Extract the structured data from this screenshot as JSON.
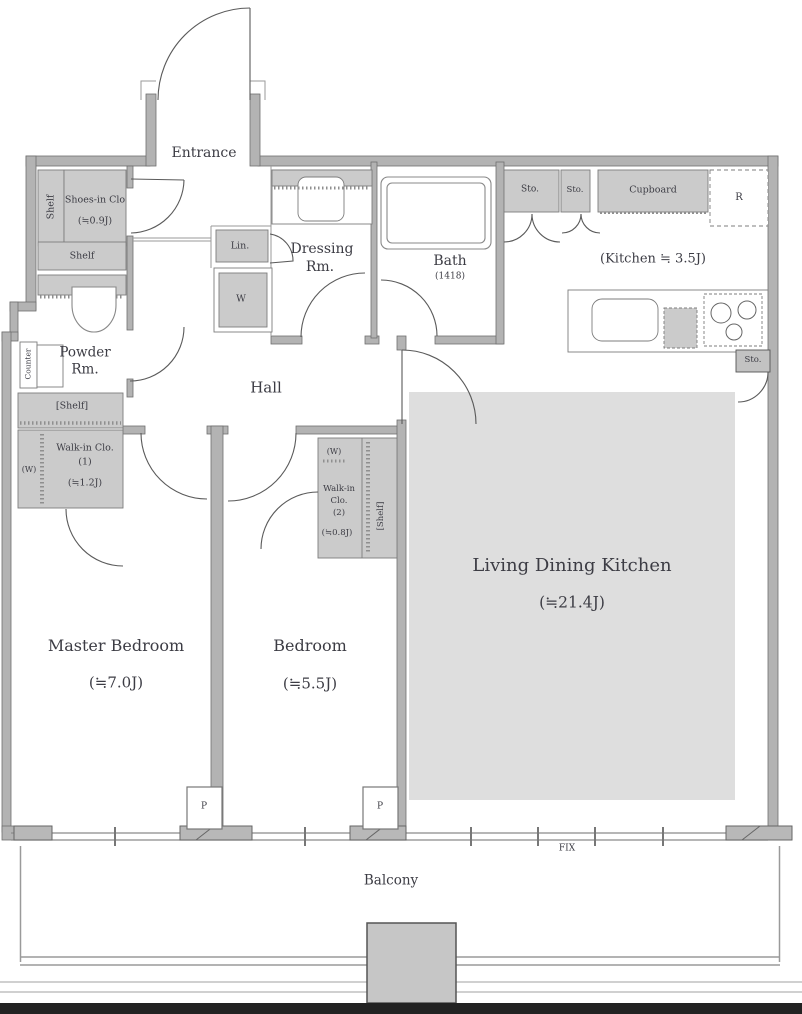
{
  "labels": {
    "entrance": "Entrance",
    "shoes_shelf_vertical": "Shelf",
    "shoes_closet": "Shoes-in Clo",
    "shoes_closet_size": "(≒0.9J)",
    "shelf_horizontal": "Shelf",
    "powder_line1": "Powder",
    "powder_line2": "Rm.",
    "counter": "Counter",
    "linen": "Lin.",
    "washer": "W",
    "dressing_line1": "Dressing",
    "dressing_line2": "Rm.",
    "bath": "Bath",
    "bath_size": "(1418)",
    "storage_a": "Sto.",
    "storage_b": "Sto.",
    "cupboard": "Cupboard",
    "refrigerator": "R",
    "kitchen": "(Kitchen ≒ 3.5J)",
    "storage_side": "Sto.",
    "hall": "Hall",
    "wic1_shelf": "[Shelf]",
    "wic1_w": "(W)",
    "wic1_line1": "Walk-in Clo.",
    "wic1_line2": "(1)",
    "wic1_size": "(≒1.2J)",
    "wic2_w": "(W)",
    "wic2_line1": "Walk-in",
    "wic2_line2": "Clo.",
    "wic2_line3": "(2)",
    "wic2_size": "(≒0.8J)",
    "wic2_shelf": "[Shelf]",
    "ldk": "Living Dining Kitchen",
    "ldk_size": "(≒21.4J)",
    "master_bedroom": "Master Bedroom",
    "master_bedroom_size": "(≒7.0J)",
    "bedroom": "Bedroom",
    "bedroom_size": "(≒5.5J)",
    "pillar_1": "P",
    "pillar_2": "P",
    "fix_window": "FIX",
    "balcony": "Balcony"
  },
  "colors": {
    "wall_fill": "#b3b3b3",
    "wall_edge": "#6f6f6f",
    "closet_fill": "#cbcbcb",
    "ldk_floor": "#dedede",
    "door_line": "#5a5a5a",
    "text": "#3c3c44",
    "bottom_bar": "#222222"
  }
}
